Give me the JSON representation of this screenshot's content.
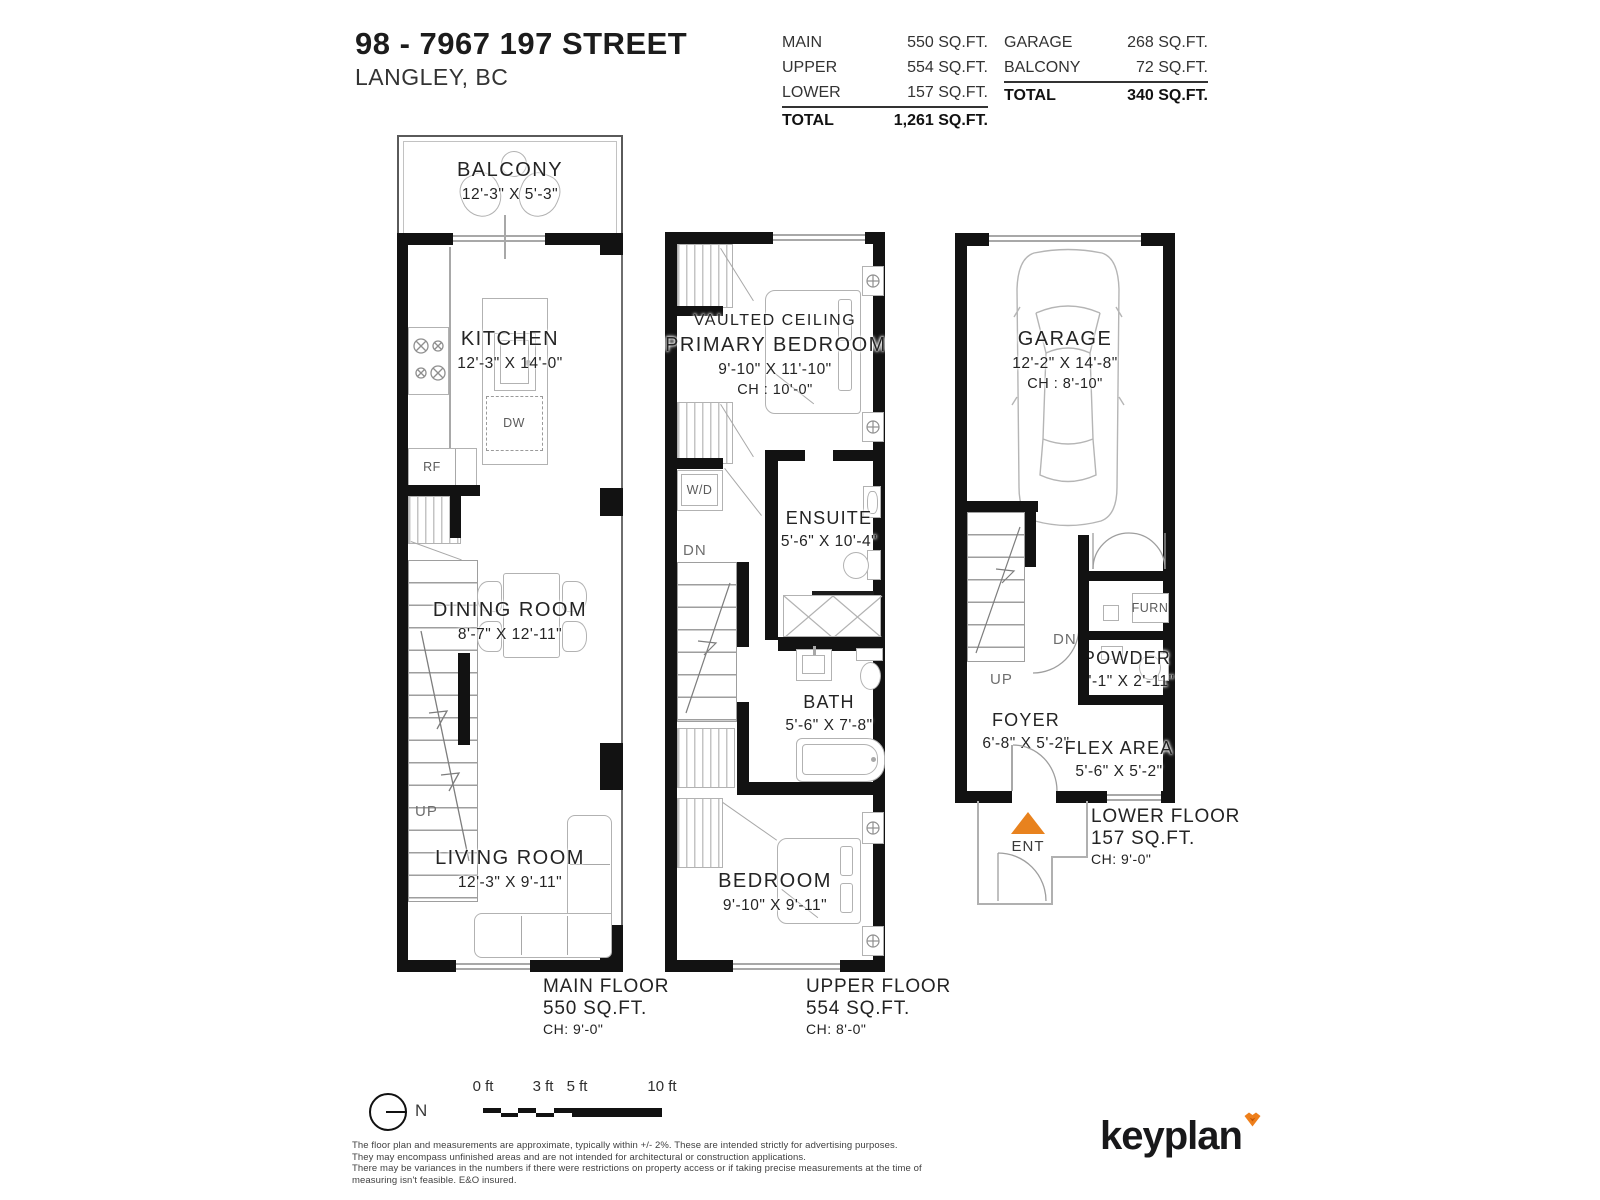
{
  "header": {
    "title": "98 - 7967 197 STREET",
    "subtitle": "LANGLEY, BC"
  },
  "tables": {
    "interior": {
      "rows": [
        {
          "label": "MAIN",
          "value": "550 SQ.FT."
        },
        {
          "label": "UPPER",
          "value": "554 SQ.FT."
        },
        {
          "label": "LOWER",
          "value": "157 SQ.FT."
        }
      ],
      "total_label": "TOTAL",
      "total_value": "1,261 SQ.FT."
    },
    "exterior": {
      "rows": [
        {
          "label": "GARAGE",
          "value": "268 SQ.FT."
        },
        {
          "label": "BALCONY",
          "value": "72 SQ.FT."
        }
      ],
      "total_label": "TOTAL",
      "total_value": "340 SQ.FT."
    }
  },
  "floors": {
    "main": {
      "caption": {
        "name": "MAIN FLOOR",
        "area": "550 SQ.FT.",
        "ch": "CH: 9'-0\""
      },
      "rooms": {
        "balcony": {
          "name": "BALCONY",
          "dims": "12'-3\"  X  5'-3\""
        },
        "kitchen": {
          "name": "KITCHEN",
          "dims": "12'-3\"  X  14'-0\""
        },
        "dining": {
          "name": "DINING ROOM",
          "dims": "8'-7\"  X  12'-11\""
        },
        "living": {
          "name": "LIVING ROOM",
          "dims": "12'-3\"  X  9'-11\""
        }
      },
      "markers": {
        "dn": "DN",
        "up": "UP",
        "dw": "DW",
        "rf": "RF"
      }
    },
    "upper": {
      "caption": {
        "name": "UPPER FLOOR",
        "area": "554 SQ.FT.",
        "ch": "CH: 8'-0\""
      },
      "rooms": {
        "primary": {
          "pre": "VAULTED CEILING",
          "name": "PRIMARY BEDROOM",
          "dims": "9'-10\"  X  11'-10\"",
          "ch": "CH : 10'-0\""
        },
        "ensuite": {
          "name": "ENSUITE",
          "dims": "5'-6\"  X  10'-4\""
        },
        "bath": {
          "name": "BATH",
          "dims": "5'-6\"  X  7'-8\""
        },
        "bedroom": {
          "name": "BEDROOM",
          "dims": "9'-10\"  X  9'-11\""
        }
      },
      "markers": {
        "wd": "W/D",
        "dn": "DN"
      }
    },
    "lower": {
      "caption": {
        "name": "LOWER FLOOR",
        "area": "157 SQ.FT.",
        "ch": "CH: 9'-0\""
      },
      "rooms": {
        "garage": {
          "name": "GARAGE",
          "dims": "12'-2\"  X  14'-8\"",
          "ch": "CH : 8'-10\""
        },
        "powder": {
          "name": "POWDER",
          "dims": "5'-1\"  X  2'-11\""
        },
        "foyer": {
          "name": "FOYER",
          "dims": "6'-8\"  X  5'-2\""
        },
        "flex": {
          "name": "FLEX AREA",
          "dims": "5'-6\"  X  5'-2\""
        }
      },
      "markers": {
        "up": "UP",
        "dn": "DN",
        "furn": "FURN",
        "ent": "ENT"
      }
    }
  },
  "footer": {
    "north_label": "N",
    "scale": {
      "ticks": [
        "0 ft",
        "3 ft",
        "5 ft",
        "10 ft"
      ]
    },
    "disclaimer": [
      "The floor plan and measurements are approximate, typically within +/- 2%. These are intended strictly for advertising purposes.",
      "They may encompass unfinished areas and are not intended for architectural or construction applications.",
      "There may be variances in the numbers if there were restrictions on property access or if taking precise measurements at the time of measuring isn't feasible. E&O insured."
    ],
    "logo_text": "keyplan",
    "accent_color": "#EE7F1B"
  }
}
